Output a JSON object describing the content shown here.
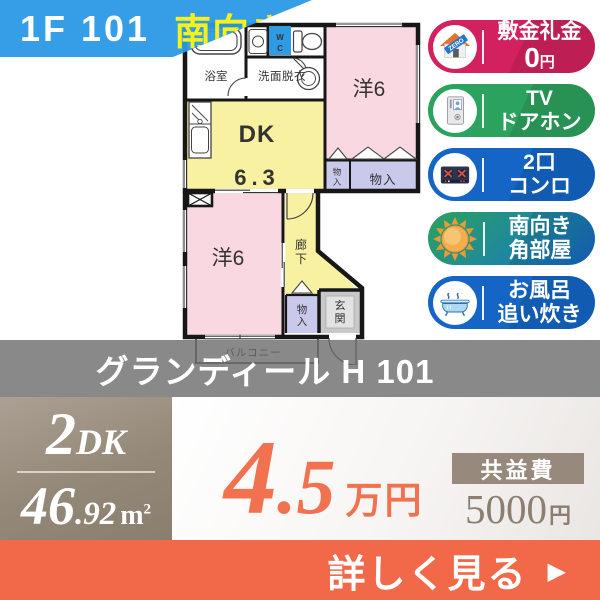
{
  "banner": {
    "unit": "1F 101",
    "facing": "南向き"
  },
  "badges": {
    "deposit": {
      "line1": "敷金礼金",
      "amount": "0",
      "unit": "円",
      "ribbon": "ZERO"
    },
    "doorphone": {
      "line1": "TV",
      "line2": "ドアホン"
    },
    "stove": {
      "line1": "2口",
      "line2": "コンロ"
    },
    "corner": {
      "line1": "南向き",
      "line2": "角部屋"
    },
    "bathtub": {
      "line1": "お風呂",
      "line2": "追い炊き"
    }
  },
  "floorplan": {
    "bath": "浴室",
    "washroom": "洗面脱衣",
    "wc_w": "W",
    "wc_c": "C",
    "western_top": "洋6",
    "dk_name": "DK",
    "dk_size": "6.3",
    "closet_small_1": "物",
    "closet_small_2": "入",
    "closet_large": "物入",
    "western_bottom": "洋6",
    "corridor_1": "廊",
    "corridor_2": "下",
    "closet_bottom_1": "物",
    "closet_bottom_2": "入",
    "entrance_1": "玄",
    "entrance_2": "関",
    "balcony": "バルコニー"
  },
  "title": {
    "name": "グランディール H 101"
  },
  "summary": {
    "layout_num": "2",
    "layout_type": "DK",
    "area_int": "46",
    "area_dec": ".92",
    "area_unit": "m",
    "area_sup": "2"
  },
  "price": {
    "rent_int": "4",
    "rent_dec": ".5",
    "rent_unit": "万円",
    "fee_label": "共益費",
    "fee_amount": "5000",
    "fee_unit": "円"
  },
  "footer": {
    "cta": "詳しく見る",
    "arrow": "▶"
  },
  "colors": {
    "banner_blue": "#2B99E5",
    "badge_pink": "#D2215E",
    "badge_green": "#2BA25D",
    "badge_blue": "#1465C6",
    "price_orange": "#F2714F",
    "footer_orange": "#F2694A",
    "taupe": "#97897C",
    "room_pink": "#F9D8E2",
    "room_yellow": "#F7F1A1",
    "closet_purple": "#C9CAEB",
    "entrance_gray": "#C8C8C8"
  }
}
